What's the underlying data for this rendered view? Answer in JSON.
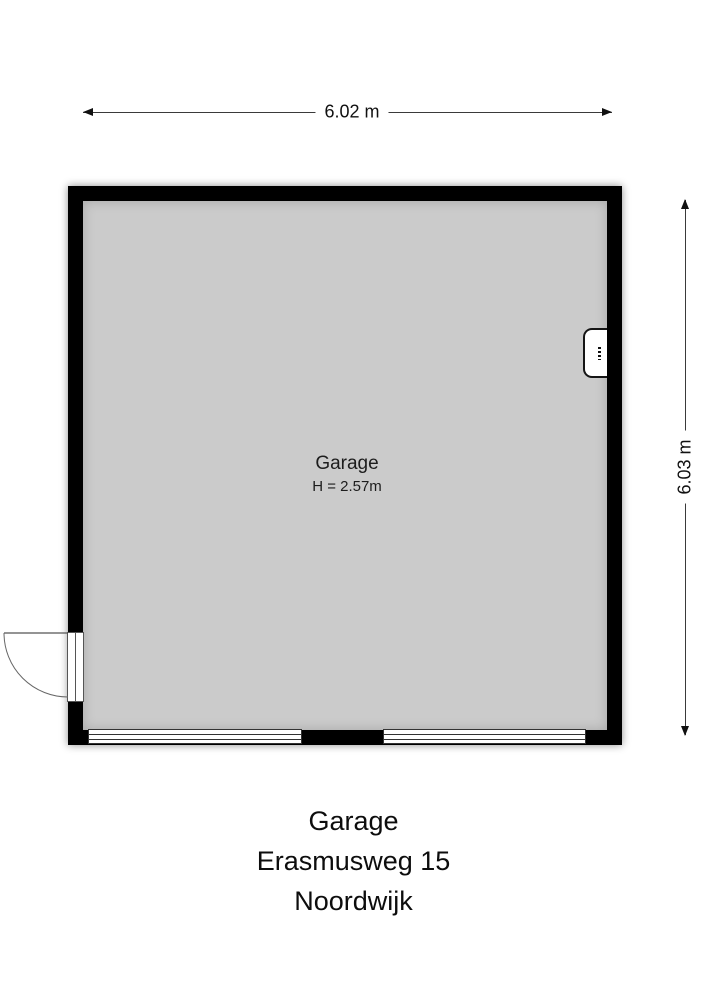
{
  "plan": {
    "room": {
      "name": "Garage",
      "height_label": "H = 2.57m"
    },
    "dimensions": {
      "width": "6.02 m",
      "height": "6.03 m"
    },
    "elements": {
      "door": "hinged-door-bottom-left",
      "wall_unit": "boiler-unit-right-wall",
      "window_count": 2
    }
  },
  "caption": {
    "title": "Garage",
    "address": "Erasmusweg 15",
    "city": "Noordwijk"
  },
  "colors": {
    "wall": "#000000",
    "floor": "#cbcbcb",
    "background": "#ffffff",
    "dimension_line": "#3a3a3a",
    "text": "#111111"
  }
}
